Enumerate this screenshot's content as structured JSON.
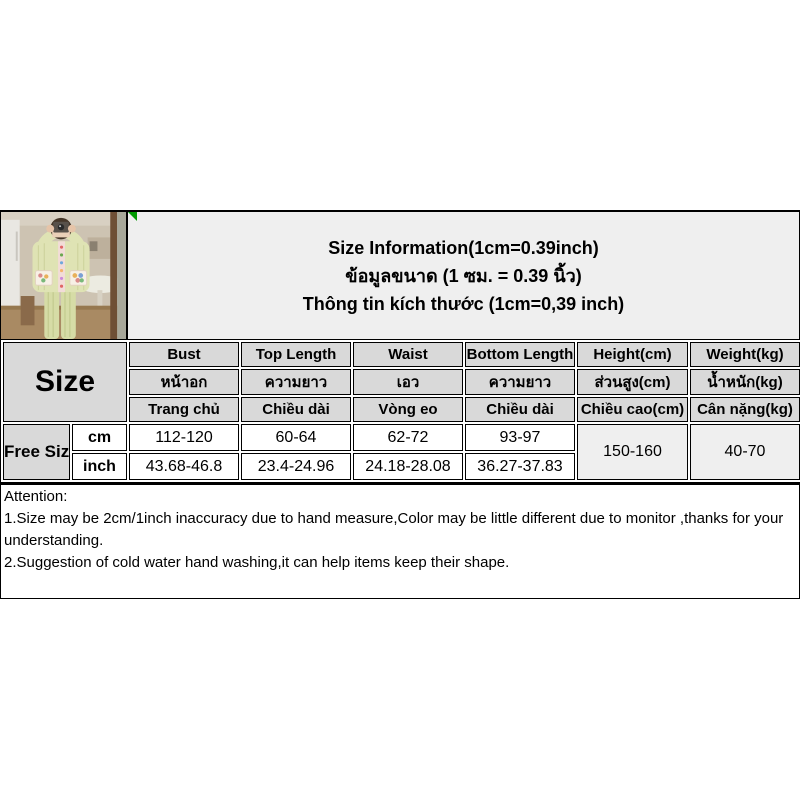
{
  "title": {
    "line_en": "Size Information(1cm=0.39inch)",
    "line_th": "ข้อมูลขนาด (1 ซม. = 0.39 นิ้ว)",
    "line_vi": "Thông tin kích thước (1cm=0,39 inch)"
  },
  "photo": {
    "alt": "pajama-set-mirror-selfie"
  },
  "table": {
    "size_label": "Size",
    "headers_en": [
      "Bust",
      "Top Length",
      "Waist",
      "Bottom Length",
      "Height(cm)",
      "Weight(kg)"
    ],
    "headers_th": [
      "หน้าอก",
      "ความยาว",
      "เอว",
      "ความยาว",
      "ส่วนสูง(cm)",
      "น้ำหนัก(kg)"
    ],
    "headers_vi": [
      "Trang chủ",
      "Chiều dài",
      "Vòng eo",
      "Chiều dài",
      "Chiều cao(cm)",
      "Cân nặng(kg)"
    ],
    "row_label": "Free Size",
    "unit_cm": "cm",
    "unit_inch": "inch",
    "cm_values": [
      "112-120",
      "60-64",
      "62-72",
      "93-97"
    ],
    "inch_values": [
      "43.68-46.8",
      "23.4-24.96",
      "24.18-28.08",
      "36.27-37.83"
    ],
    "height_value": "150-160",
    "weight_value": "40-70"
  },
  "attention": {
    "heading": "Attention:",
    "line1": "1.Size may be 2cm/1inch inaccuracy due to hand measure,Color may be little different due to monitor ,thanks for your understanding.",
    "line2": "2.Suggestion of cold water hand washing,it can help items keep their shape."
  },
  "colors": {
    "header_bg": "#d9d9d9",
    "panel_bg": "#efefef",
    "border": "#000000",
    "corner_marker_green": "#009a00"
  }
}
